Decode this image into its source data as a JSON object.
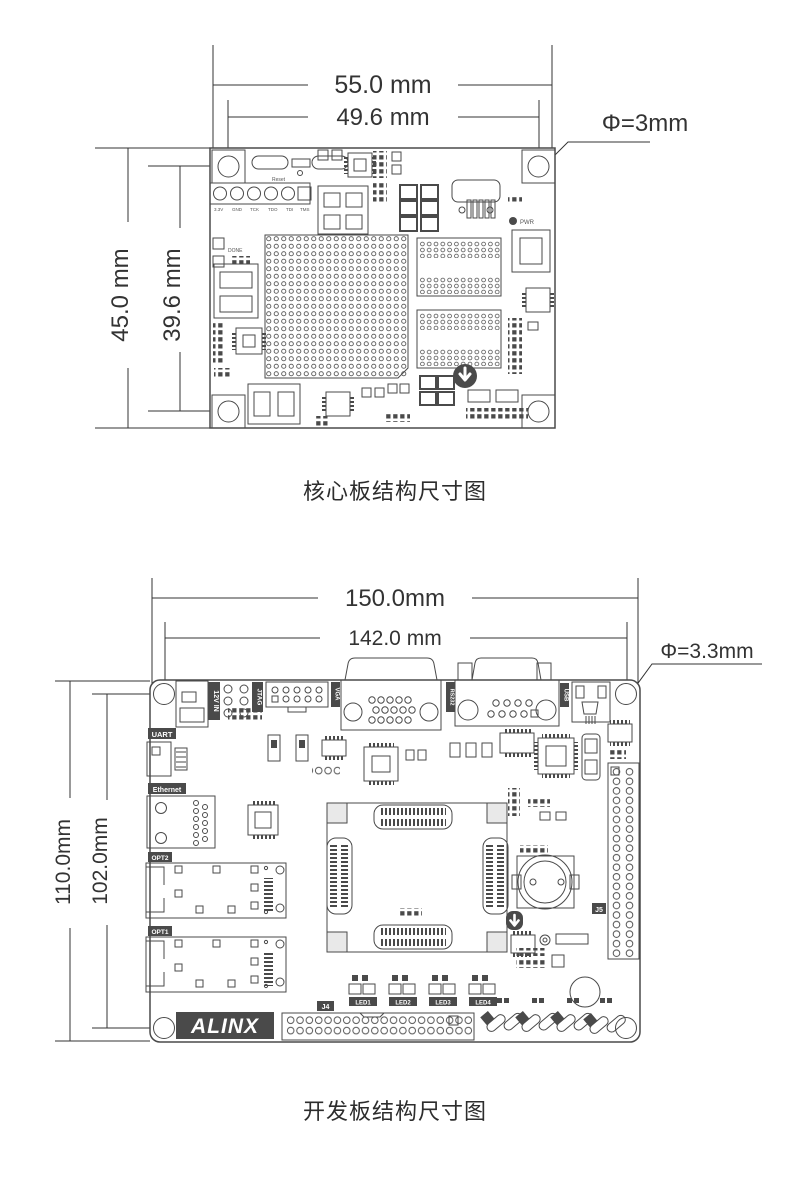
{
  "page": {
    "background": "#ffffff",
    "line_color": "#4a4a4a",
    "tag_color": "#4a4a4a"
  },
  "core_board": {
    "caption": "核心板结构尺寸图",
    "dims": {
      "width_outer": "55.0 mm",
      "width_inner": "49.6 mm",
      "height_outer": "45.0 mm",
      "height_inner": "39.6 mm",
      "hole": "Φ=3mm"
    },
    "silkscreen": {
      "reset": "Reset",
      "done": "DONE",
      "pwr": "PWR",
      "jtag_pins": [
        "3.3V",
        "GND",
        "TCK",
        "TDO",
        "TDI",
        "TMS"
      ]
    }
  },
  "dev_board": {
    "caption": "开发板结构尺寸图",
    "dims": {
      "width_outer": "150.0mm",
      "width_inner": "142.0 mm",
      "height_outer": "110.0mm",
      "height_inner": "102.0mm",
      "hole": "Φ=3.3mm"
    },
    "ports": {
      "power": "12V IN",
      "jtag": "JTAG",
      "vga": "VGA",
      "rs232": "RS232",
      "usb": "USB",
      "uart": "UART",
      "ethernet": "Ethernet",
      "opt2": "OPT2",
      "opt1": "OPT1"
    },
    "refs": {
      "j4": "J4",
      "j5": "J5"
    },
    "leds": [
      "LED1",
      "LED2",
      "LED3",
      "LED4"
    ],
    "brand": "ALINX"
  }
}
